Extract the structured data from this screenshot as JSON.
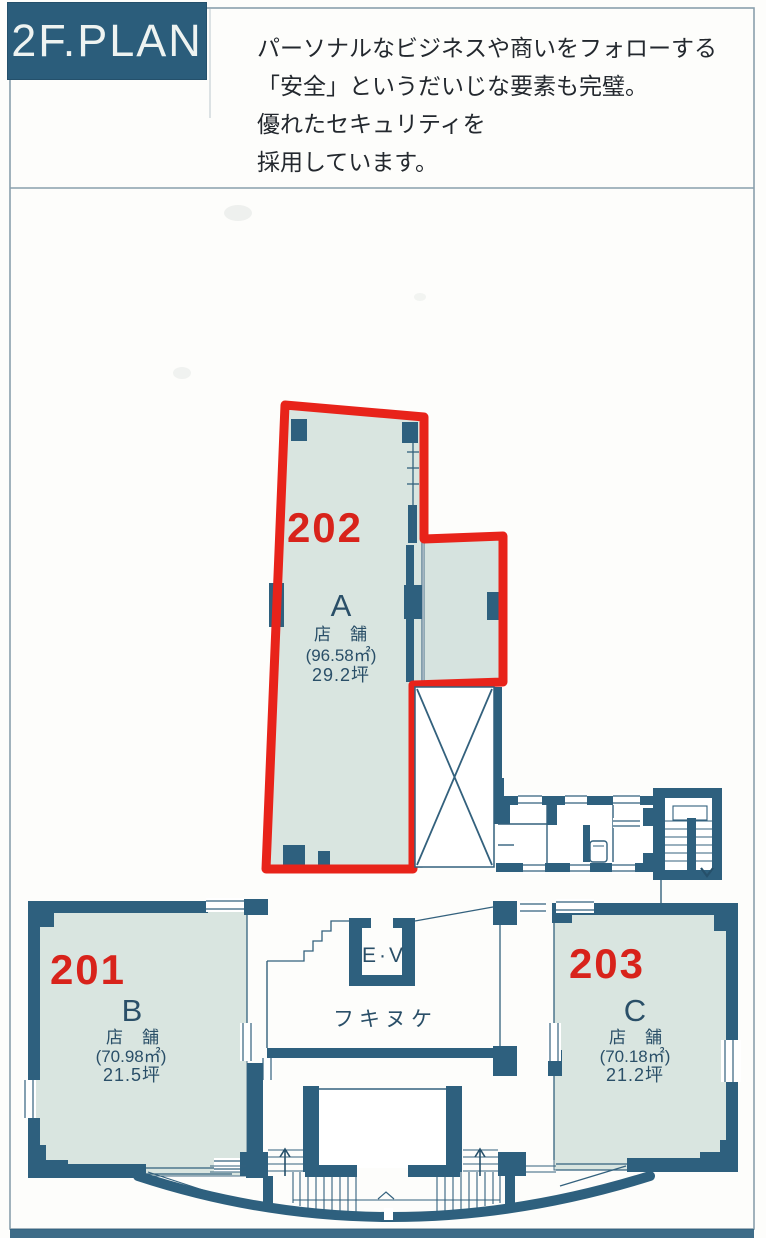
{
  "header": {
    "title": "2F.PLAN"
  },
  "intro": {
    "line1": "パーソナルなビジネスや商いをフォローする",
    "line2": "「安全」というだいじな要素も完璧。",
    "line3": "優れたセキュリティを",
    "line4": "採用しています。"
  },
  "plan": {
    "units": [
      {
        "id": "202",
        "room_letter": "A",
        "use": "店　舗",
        "area_m2": "(96.58㎡)",
        "area_tsubo": "29.2坪"
      },
      {
        "id": "201",
        "room_letter": "B",
        "use": "店　舗",
        "area_m2": "(70.98㎡)",
        "area_tsubo": "21.5坪"
      },
      {
        "id": "203",
        "room_letter": "C",
        "use": "店　舗",
        "area_m2": "(70.18㎡)",
        "area_tsubo": "21.2坪"
      }
    ],
    "labels": {
      "elevator": "E·V",
      "atrium": "フキヌケ"
    },
    "colors": {
      "wall": "#2e607e",
      "room_fill": "#d9e5e0",
      "highlight_red": "#e8231a"
    }
  }
}
